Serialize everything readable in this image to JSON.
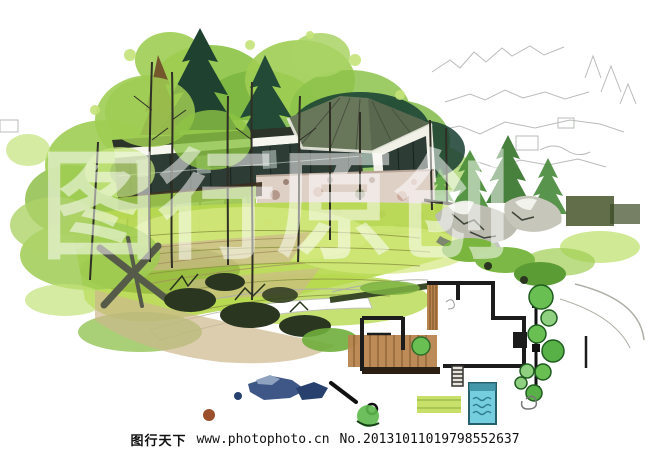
{
  "footer": {
    "site_name": "图行天下",
    "site_url": "www.photophoto.cn",
    "serial": "No.20131011019798552637"
  },
  "watermark": {
    "text": "图行原创"
  },
  "artwork": {
    "kind": "hand-drawn marker/watercolor landscape architecture rendering",
    "elements": [
      "tree-canopy",
      "conifer-trees",
      "pavilion-house",
      "stone-wall",
      "sloped-lawn",
      "boulders",
      "garden-path",
      "shrubs",
      "site-floor-plan",
      "swimming-pool",
      "plan-trees"
    ]
  },
  "palette": {
    "canopyLight": "#9fcd52",
    "canopyLighter": "#c3e379",
    "canopyMid": "#7ab53e",
    "conifer": "#1f4130",
    "coniferTeal": "#1d4536",
    "spireBrown": "#6f4a28",
    "lawn": "#b7d94f",
    "lawnLight": "#d3e87e",
    "lawnDeep": "#8fb63a",
    "tan": "#cdb88d",
    "stone": "#dfd0c6",
    "roofDark": "#2c3328",
    "roofHip": "#68765a",
    "glass": "#2d3c35",
    "wallWhite": "#f2f1e8",
    "rockGray": "#bcbcb0",
    "rockBlue": "#3f5787",
    "poolBlue": "#74cede",
    "wood": "#b9854e",
    "planTree": "#6abf52",
    "ink": "#1c1c1c",
    "pencil": "#a8aca8"
  }
}
